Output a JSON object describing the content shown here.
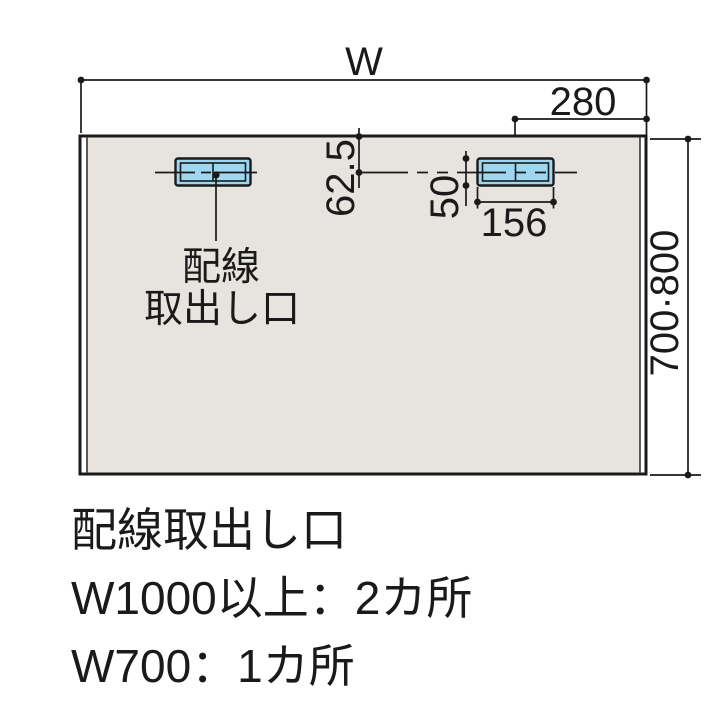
{
  "diagram": {
    "dim_width_label": "W",
    "dim_right_offset": "280",
    "dim_top_offset": "62.5",
    "dim_outlet_height": "50",
    "dim_outlet_width": "156",
    "dim_panel_height": "700·800",
    "outlet_label": [
      "配線",
      "取出し口"
    ]
  },
  "notes": {
    "title": "配線取出し口",
    "line2": "W1000以上：2カ所",
    "line3": "W700：1カ所"
  },
  "colors": {
    "panel_fill": "#e7e3de",
    "outlet_fill": "#9fd6f0",
    "line": "#1a1a1a",
    "background": "#ffffff"
  }
}
